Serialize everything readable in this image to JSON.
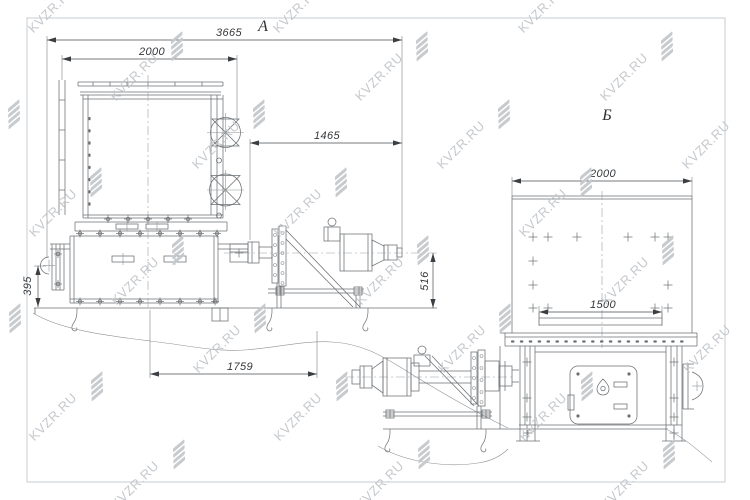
{
  "watermark": {
    "text": "KVZR.RU"
  },
  "views": {
    "view_a": {
      "label": "А",
      "dimensions": [
        {
          "name": "overall-length",
          "value": "3665"
        },
        {
          "name": "housing-width",
          "value": "2000"
        },
        {
          "name": "drive-length",
          "value": "1465"
        },
        {
          "name": "base-height",
          "value": "395"
        },
        {
          "name": "anchor-span",
          "value": "1759"
        },
        {
          "name": "axis-height",
          "value": "516"
        }
      ]
    },
    "view_b": {
      "label": "Б",
      "dimensions": [
        {
          "name": "housing-width",
          "value": "2000"
        },
        {
          "name": "opening-width",
          "value": "1500"
        }
      ]
    }
  },
  "colors": {
    "background": "#ffffff",
    "frame": "#c6ccd2",
    "line": "#6b6f72",
    "dimension": "#3c3f42",
    "watermark": "#c2c6ca"
  }
}
